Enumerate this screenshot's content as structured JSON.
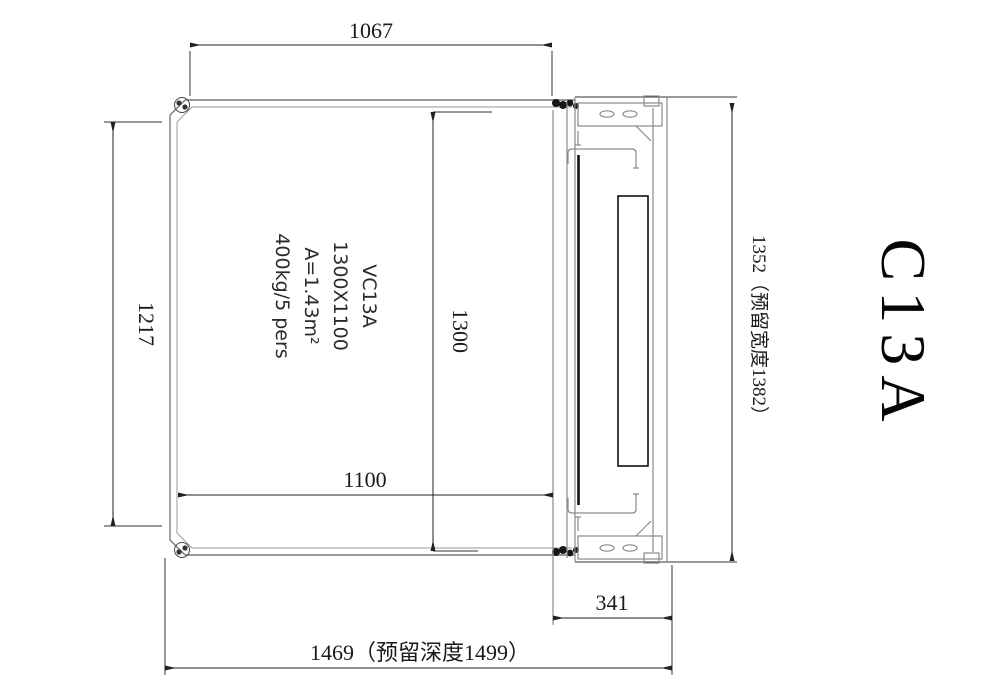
{
  "drawing": {
    "model_label": "C13A",
    "cabin_text": {
      "line1": "VC13A",
      "line2": "1300X1100",
      "line3": "A=1.43m²",
      "line4": "400kg/5 pers"
    },
    "dimensions": {
      "top_width": "1067",
      "left_height": "1217",
      "cabin_depth": "1300",
      "cabin_width": "1100",
      "right_width_reserved": "1352（预留宽度1382）",
      "door_depth": "341",
      "total_depth_reserved": "1469（预留深度1499）"
    }
  }
}
